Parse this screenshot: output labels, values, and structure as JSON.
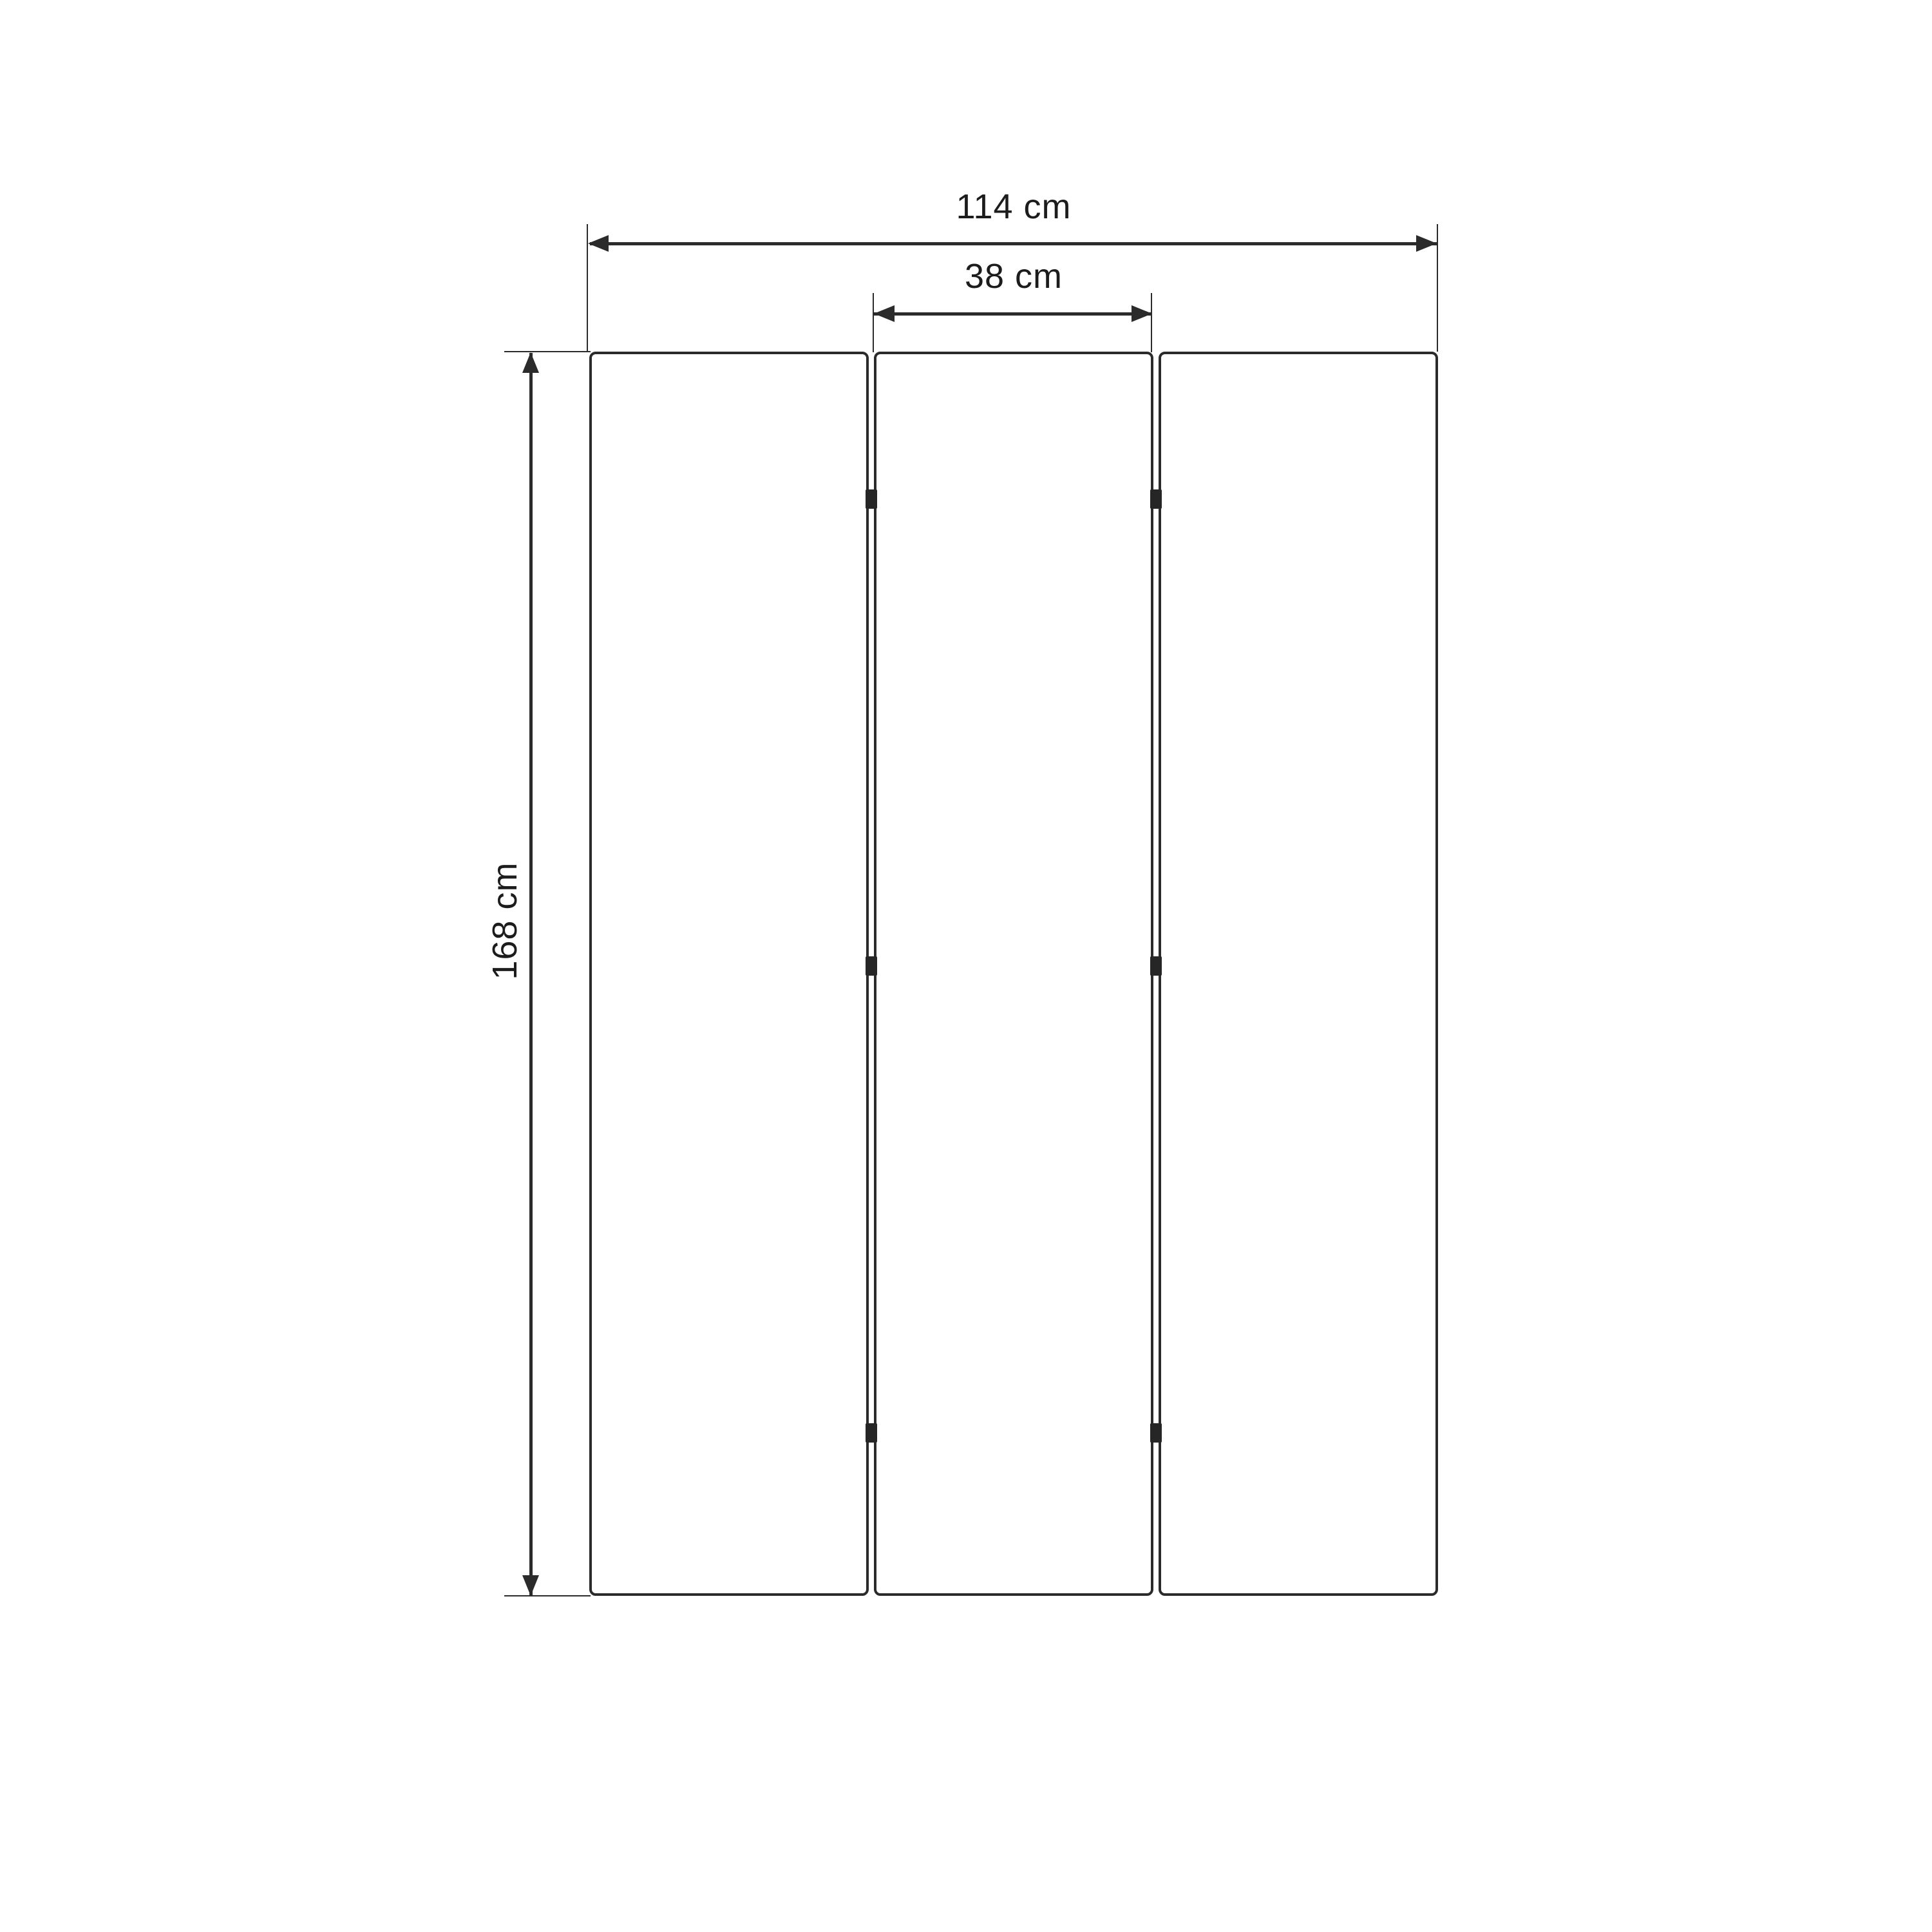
{
  "title": "Three-panel folding screen — dimension drawing",
  "diagram": {
    "object": "three-panel-folding-screen-front-view",
    "panel_count": 3,
    "hinge_rows": 3,
    "labels": {
      "total_width": "114 cm",
      "panel_width": "38 cm",
      "height": "168 cm"
    },
    "values": {
      "total_width_cm": 114,
      "panel_width_cm": 38,
      "height_cm": 168
    },
    "colors": {
      "background": "#ffffff",
      "stroke": "#2b2b2b",
      "hinge": "#262626",
      "text": "#1c1c1c"
    }
  }
}
